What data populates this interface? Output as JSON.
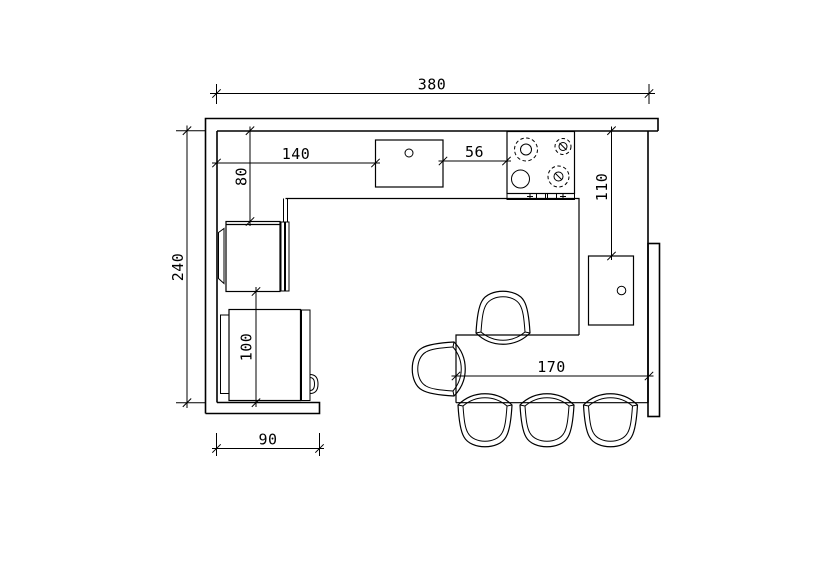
{
  "drawing": {
    "background": "#ffffff",
    "line_color": "#000000",
    "dimensions": {
      "overall_width": "380",
      "overall_height": "240",
      "wall_to_sink": "140",
      "sink_to_stove": "56",
      "wall_to_tall_unit": "80",
      "wall_to_side_cabinet": "110",
      "fridge_zone_depth": "100",
      "table_length": "170",
      "bottom_wall_stub": "90"
    }
  }
}
